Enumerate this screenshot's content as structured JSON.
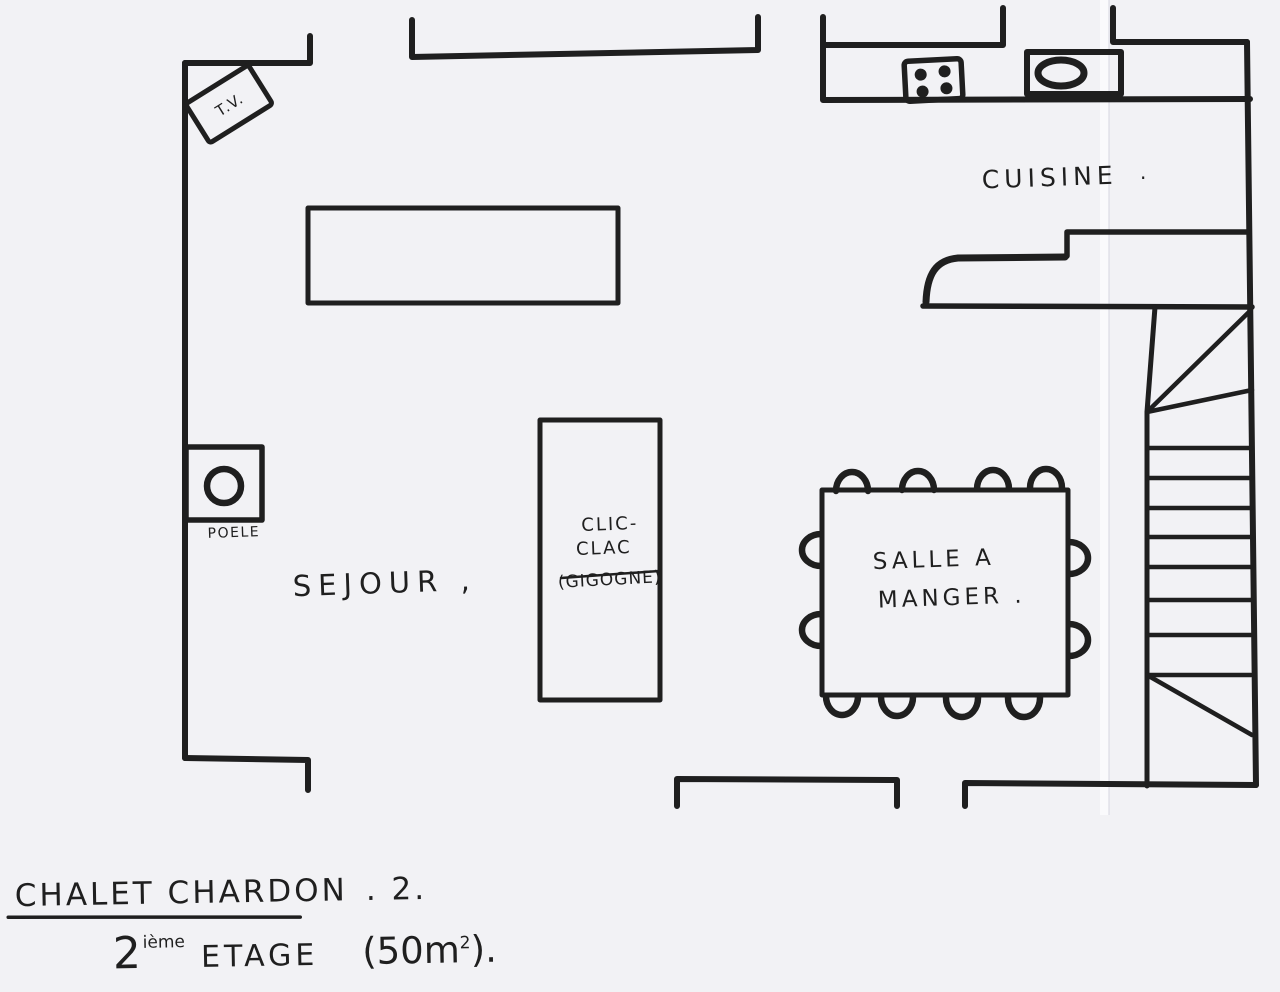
{
  "labels": {
    "tv": "T.V.",
    "poele": "POELE",
    "sejour": "SEJOUR ,",
    "cuisine": "CUISINE",
    "cuisine_dot": ".",
    "clic_line1": "CLIC-",
    "clic_line2": "CLAC",
    "clic_line3": "(GIGOGNE)",
    "salle_line1": "SALLE A",
    "salle_line2": "MANGER ."
  },
  "footer": {
    "title": "CHALET CHARDON",
    "title_suffix": ". 2.",
    "floor_num": "2",
    "floor_sup": "ième",
    "floor_word": "ETAGE",
    "area_open": "(50m",
    "area_sup": "2",
    "area_close": ")."
  },
  "plan": {
    "building": "CHALET CHARDON . 2.",
    "floor": "2ième ETAGE (50m²).",
    "rooms": [
      {
        "name": "SEJOUR",
        "items": [
          "T.V.",
          "POELE",
          "CLIC-CLAC (GIGOGNE)",
          "long table"
        ]
      },
      {
        "name": "CUISINE",
        "items": [
          "cooktop with 4 burners",
          "sink",
          "rounded bar counter"
        ]
      },
      {
        "name": "SALLE A MANGER",
        "items": [
          "dining table",
          "12 chairs"
        ]
      }
    ],
    "features": [
      "winder staircase along right wall",
      "wall openings for windows and doors"
    ]
  },
  "colors": {
    "ink": "#1f1f1f",
    "paper": "#f2f2f5"
  }
}
